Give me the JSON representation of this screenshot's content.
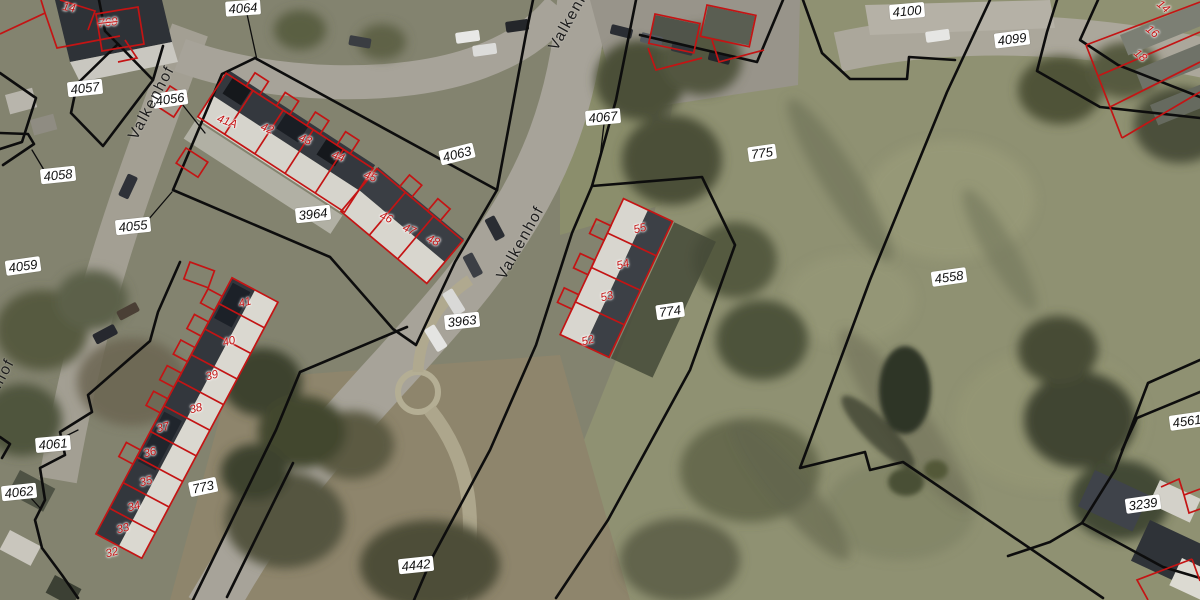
{
  "map": {
    "title": "Cadastral parcel map over aerial photo",
    "street_name": "Valkenhof",
    "colors": {
      "parcel_line": "#0d0d0d",
      "building_line": "#c41414",
      "parcel_label_bg": "#ffffff",
      "parcel_label_text": "#111111",
      "building_label_text": "#c41414",
      "street_label_text": "#1c1c1c"
    },
    "street_labels": [
      {
        "text": "Valkenhof",
        "x": 152,
        "y": 103,
        "rot": -62
      },
      {
        "text": "Valkenhof",
        "x": 521,
        "y": 243,
        "rot": -61
      },
      {
        "text": "Valkenhof",
        "x": 573,
        "y": 14,
        "rot": -61
      },
      {
        "text": "Valkenhof",
        "x": -8,
        "y": 396,
        "rot": -62
      }
    ],
    "parcel_labels": [
      {
        "text": "4064",
        "x": 243,
        "y": 8,
        "rot": -4
      },
      {
        "text": "4100",
        "x": 907,
        "y": 11,
        "rot": -5
      },
      {
        "text": "4099",
        "x": 1012,
        "y": 39,
        "rot": -7
      },
      {
        "text": "4057",
        "x": 85,
        "y": 88,
        "rot": -6
      },
      {
        "text": "4056",
        "x": 170,
        "y": 99,
        "rot": -8
      },
      {
        "text": "4067",
        "x": 603,
        "y": 117,
        "rot": -5
      },
      {
        "text": "4063",
        "x": 457,
        "y": 154,
        "rot": -14
      },
      {
        "text": "775",
        "x": 762,
        "y": 153,
        "rot": -8
      },
      {
        "text": "4058",
        "x": 58,
        "y": 175,
        "rot": -6
      },
      {
        "text": "3964",
        "x": 313,
        "y": 214,
        "rot": -6
      },
      {
        "text": "4055",
        "x": 133,
        "y": 226,
        "rot": -6
      },
      {
        "text": "4059",
        "x": 23,
        "y": 266,
        "rot": -8
      },
      {
        "text": "4558",
        "x": 949,
        "y": 277,
        "rot": -8
      },
      {
        "text": "774",
        "x": 670,
        "y": 311,
        "rot": -8
      },
      {
        "text": "3963",
        "x": 462,
        "y": 321,
        "rot": -6
      },
      {
        "text": "4561",
        "x": 1187,
        "y": 421,
        "rot": -8
      },
      {
        "text": "4061",
        "x": 53,
        "y": 444,
        "rot": -5
      },
      {
        "text": "773",
        "x": 203,
        "y": 487,
        "rot": -12
      },
      {
        "text": "4062",
        "x": 19,
        "y": 492,
        "rot": -6
      },
      {
        "text": "3239",
        "x": 1143,
        "y": 504,
        "rot": -8
      },
      {
        "text": "4442",
        "x": 416,
        "y": 565,
        "rot": -6
      }
    ],
    "building_labels": [
      {
        "text": "14",
        "x": 69,
        "y": 8,
        "rot": 10
      },
      {
        "text": "768",
        "x": 108,
        "y": 23,
        "rot": -6,
        "strike": true
      },
      {
        "text": "41A",
        "x": 227,
        "y": 122,
        "rot": 20
      },
      {
        "text": "42",
        "x": 267,
        "y": 129,
        "rot": 20
      },
      {
        "text": "43",
        "x": 305,
        "y": 140,
        "rot": 20
      },
      {
        "text": "44",
        "x": 338,
        "y": 157,
        "rot": 20
      },
      {
        "text": "45",
        "x": 370,
        "y": 177,
        "rot": 20
      },
      {
        "text": "46",
        "x": 386,
        "y": 218,
        "rot": 24
      },
      {
        "text": "47",
        "x": 409,
        "y": 230,
        "rot": 24
      },
      {
        "text": "48",
        "x": 433,
        "y": 241,
        "rot": 24
      },
      {
        "text": "55",
        "x": 640,
        "y": 229,
        "rot": -15
      },
      {
        "text": "54",
        "x": 623,
        "y": 265,
        "rot": -15
      },
      {
        "text": "53",
        "x": 607,
        "y": 297,
        "rot": -15
      },
      {
        "text": "52",
        "x": 588,
        "y": 341,
        "rot": -15
      },
      {
        "text": "41",
        "x": 245,
        "y": 303,
        "rot": -15
      },
      {
        "text": "40",
        "x": 229,
        "y": 342,
        "rot": -15
      },
      {
        "text": "39",
        "x": 212,
        "y": 376,
        "rot": -15
      },
      {
        "text": "38",
        "x": 196,
        "y": 409,
        "rot": -15
      },
      {
        "text": "37",
        "x": 163,
        "y": 428,
        "rot": -15
      },
      {
        "text": "36",
        "x": 150,
        "y": 453,
        "rot": -15
      },
      {
        "text": "35",
        "x": 146,
        "y": 482,
        "rot": -15
      },
      {
        "text": "34",
        "x": 134,
        "y": 507,
        "rot": -15
      },
      {
        "text": "33",
        "x": 123,
        "y": 529,
        "rot": -15
      },
      {
        "text": "32",
        "x": 112,
        "y": 553,
        "rot": -15
      },
      {
        "text": "14",
        "x": 1163,
        "y": 7,
        "rot": 40
      },
      {
        "text": "16",
        "x": 1152,
        "y": 32,
        "rot": 40
      },
      {
        "text": "18",
        "x": 1140,
        "y": 56,
        "rot": 40
      }
    ]
  }
}
